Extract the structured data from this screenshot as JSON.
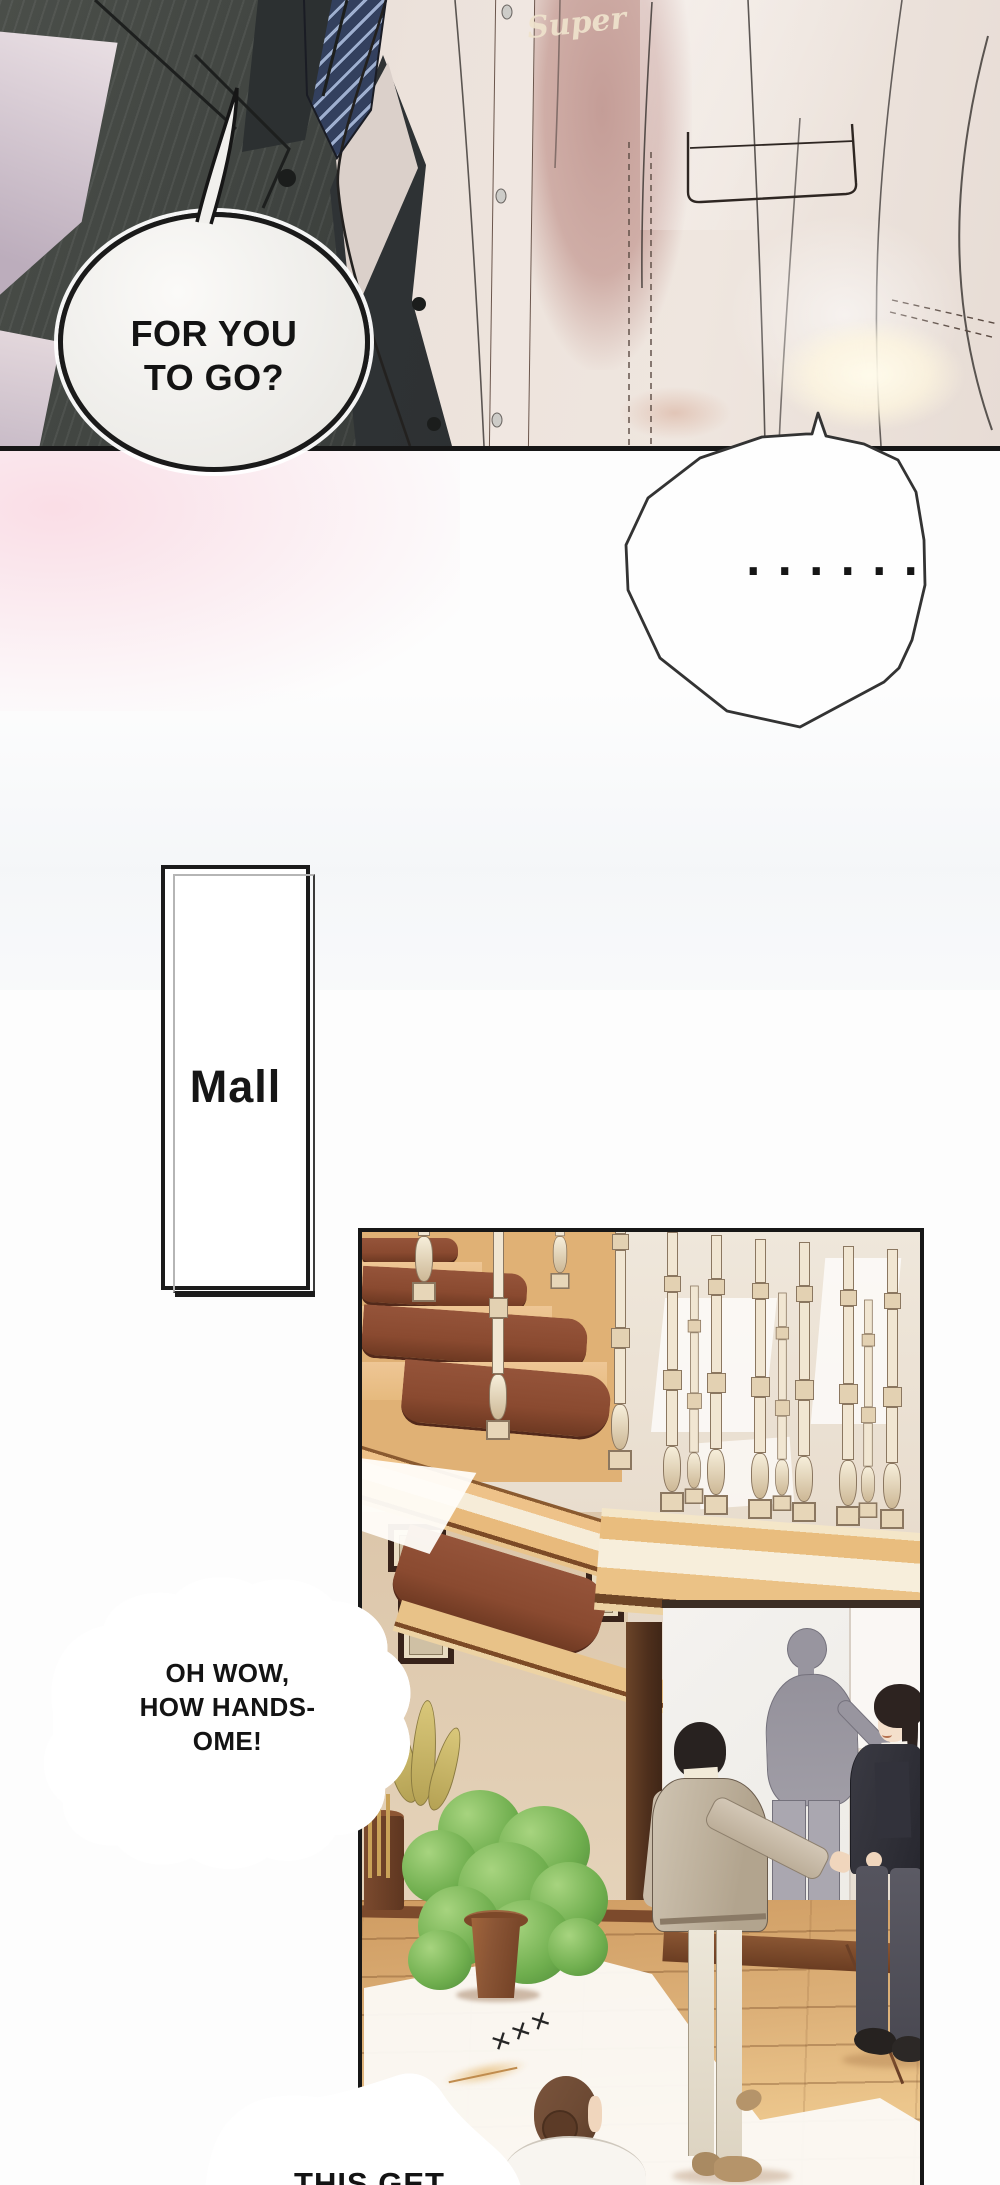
{
  "panel_top": {
    "speech_bubble": {
      "lines": [
        "FOR YOU",
        "TO GO?"
      ]
    },
    "shirt_logo": "Super"
  },
  "silence_bubble": {
    "dots": "......"
  },
  "mall_sign": {
    "label": "Mall"
  },
  "panel_mall": {
    "speech_bubble": {
      "lines": [
        "OH WOW,",
        "HOW HANDS-",
        "OME!"
      ]
    },
    "floor_marks": "✕✕✕",
    "bottom_bubble": {
      "text": "THIS GET"
    }
  },
  "colors": {
    "suit_dark": "#3c403d",
    "suit_shadow": "#24282a",
    "tie_navy": "#33405e",
    "tie_stripe": "#9fb0d0",
    "chest_pink": "#c49d97",
    "logo_cream": "#efe3cd",
    "bubble_fill": "#f1f0ed",
    "wood_tread": "#8a4a30",
    "wood_light": "#e6ba7e",
    "wood_cream": "#f6ecd8",
    "wall_beige": "#e8ddd0",
    "frames_wall": "#dcc6aa",
    "frame_brown": "#38231a",
    "door_brown": "#4e2f1c",
    "poster_white": "#f4f2ef",
    "silhouette_gray": "#98959f",
    "silhouette_light": "#aaa7b0",
    "coat_beige": "#cfc4b2",
    "coat_shadow": "#b2a48e",
    "suit2_dark": "#33333b",
    "trousers2_gray": "#55545e",
    "cream_trousers": "#ece6d8",
    "shoe_tan": "#b5946a",
    "floor_tan": "#ddb179",
    "floor_dark": "#8a5633",
    "floor_white": "#fbf9f5",
    "plant_green": "#6fae4e",
    "plant_light": "#a7d47f",
    "plant_dark": "#4e8a38",
    "leaf_yellow": "#d9c77a",
    "pot_brown": "#8a5535",
    "hair_brown": "#6d4a34",
    "skin": "#f0d6bd"
  }
}
